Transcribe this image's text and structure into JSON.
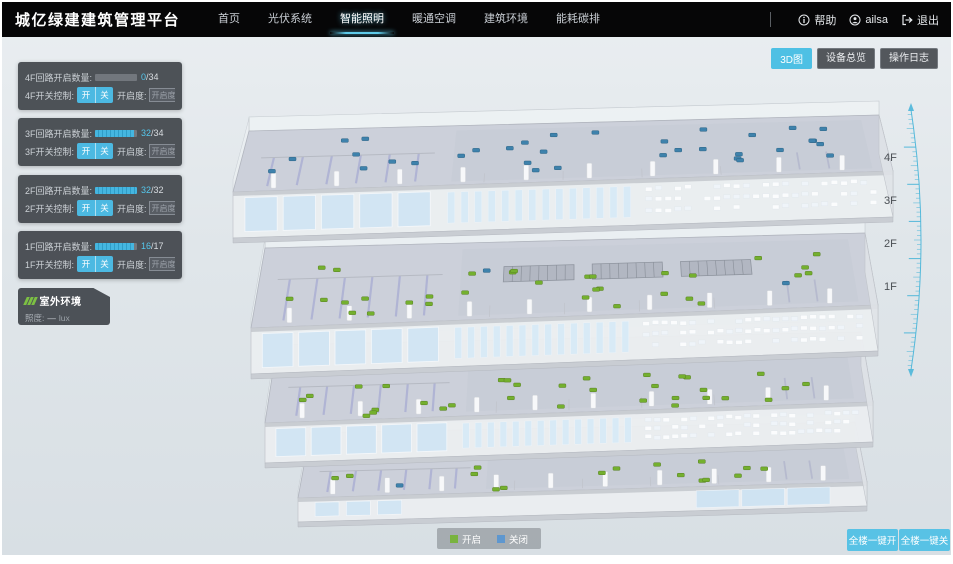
{
  "header": {
    "logo": "城亿绿建建筑管理平台",
    "nav": [
      {
        "label": "首页",
        "active": false
      },
      {
        "label": "光伏系统",
        "active": false
      },
      {
        "label": "智能照明",
        "active": true
      },
      {
        "label": "暖通空调",
        "active": false
      },
      {
        "label": "建筑环境",
        "active": false
      },
      {
        "label": "能耗碳排",
        "active": false
      }
    ],
    "help": "帮助",
    "username": "ailsa",
    "logout": "退出"
  },
  "view_toolbar": {
    "view_3d": "3D图",
    "device_overview": "设备总览",
    "operation_log": "操作日志"
  },
  "floor_panels": [
    {
      "floor": "4F",
      "circuit_label": "4F回路开启数量:",
      "count_on": "0",
      "count_rest": "/34",
      "on_num": 0,
      "total_num": 34,
      "switch_label": "4F开关控制:",
      "btn_on": "开",
      "btn_off": "关",
      "dim_label": "开启度:",
      "dim_placeholder": "开启度",
      "percent": "%"
    },
    {
      "floor": "3F",
      "circuit_label": "3F回路开启数量:",
      "count_on": "32",
      "count_rest": "/34",
      "on_num": 32,
      "total_num": 34,
      "switch_label": "3F开关控制:",
      "btn_on": "开",
      "btn_off": "关",
      "dim_label": "开启度:",
      "dim_placeholder": "开启度",
      "percent": "%"
    },
    {
      "floor": "2F",
      "circuit_label": "2F回路开启数量:",
      "count_on": "32",
      "count_rest": "/32",
      "on_num": 32,
      "total_num": 32,
      "switch_label": "2F开关控制:",
      "btn_on": "开",
      "btn_off": "关",
      "dim_label": "开启度:",
      "dim_placeholder": "开启度",
      "percent": "%"
    },
    {
      "floor": "1F",
      "circuit_label": "1F回路开启数量:",
      "count_on": "16",
      "count_rest": "/17",
      "on_num": 16,
      "total_num": 17,
      "switch_label": "1F开关控制:",
      "btn_on": "开",
      "btn_off": "关",
      "dim_label": "开启度:",
      "dim_placeholder": "开启度",
      "percent": "%"
    }
  ],
  "outdoor_panel": {
    "title": "室外环境",
    "metric_label": "照度:",
    "metric_value": "—",
    "metric_unit": "lux"
  },
  "scene": {
    "floor_labels": [
      "4F",
      "3F",
      "2F",
      "1F"
    ]
  },
  "legend": {
    "on_label": "开启",
    "off_label": "关闭"
  },
  "bottom_actions": {
    "all_on": "全楼一键开",
    "all_off": "全楼一键关"
  },
  "colors": {
    "accent": "#4ec0e4",
    "light_on": "#74b02e",
    "light_off": "#3e82ac",
    "legend_on": "#79b33f",
    "legend_off": "#5e97cf"
  }
}
